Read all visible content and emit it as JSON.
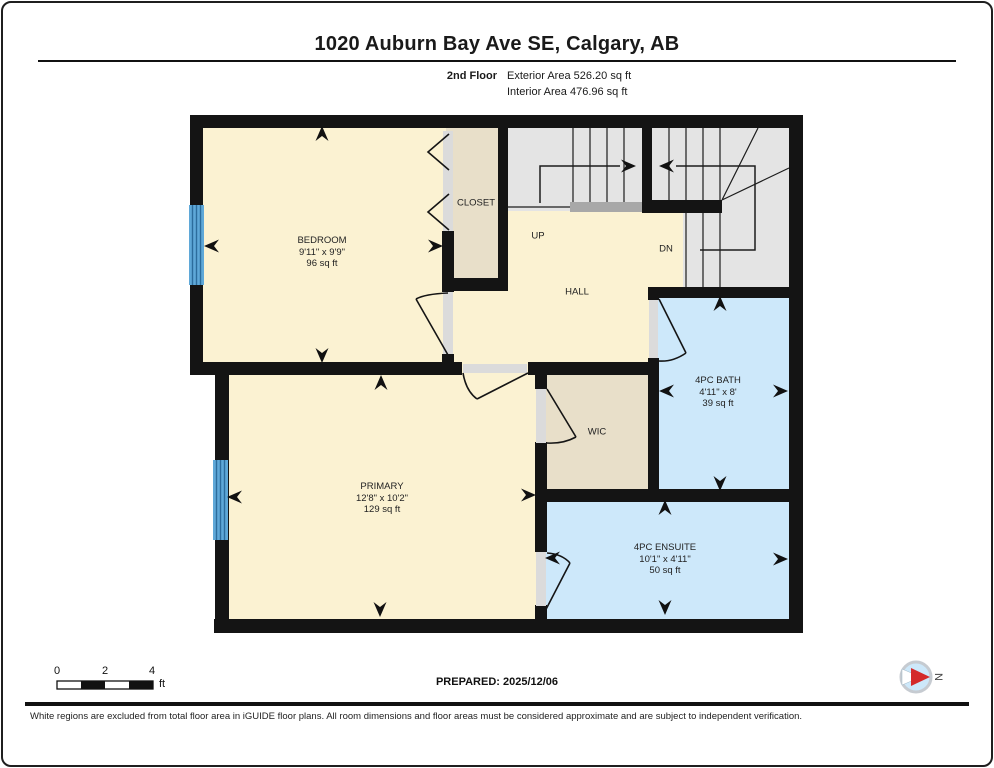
{
  "header": {
    "title": "1020 Auburn Bay Ave SE, Calgary, AB",
    "floor_label": "2nd Floor",
    "exterior_area": "Exterior Area 526.20 sq ft",
    "interior_area": "Interior Area 476.96 sq ft"
  },
  "rooms": {
    "bedroom": {
      "name": "BEDROOM",
      "dims": "9'11\" x 9'9\"",
      "area": "96 sq ft"
    },
    "closet": {
      "name": "CLOSET"
    },
    "hall": {
      "name": "HALL"
    },
    "up": {
      "name": "UP"
    },
    "dn": {
      "name": "DN"
    },
    "bath": {
      "name": "4PC BATH",
      "dims": "4'11\" x 8'",
      "area": "39 sq ft"
    },
    "wic": {
      "name": "WIC"
    },
    "primary": {
      "name": "PRIMARY",
      "dims": "12'8\" x 10'2\"",
      "area": "129 sq ft"
    },
    "ensuite": {
      "name": "4PC ENSUITE",
      "dims": "10'1\" x 4'11\"",
      "area": "50 sq ft"
    }
  },
  "footer": {
    "scale_ticks": [
      "0",
      "2",
      "4"
    ],
    "scale_unit": "ft",
    "prepared": "PREPARED: 2025/12/06",
    "compass_label": "N",
    "disclaimer": "White regions are excluded from total floor area in iGUIDE floor plans. All room dimensions and floor areas must be considered approximate and are subject to independent verification."
  },
  "colors": {
    "room_cream": "#FBF2D2",
    "closet_tan": "#E8DFC9",
    "stair_gray": "#E4E4E4",
    "stair_edge_gray": "#A8A8A8",
    "wet_room_blue": "#CDE8FA",
    "window_blue": "#5FA8D8",
    "window_stripe_blue": "#2C6C9C",
    "compass_red": "#D42A2A",
    "wall_black": "#141414"
  }
}
